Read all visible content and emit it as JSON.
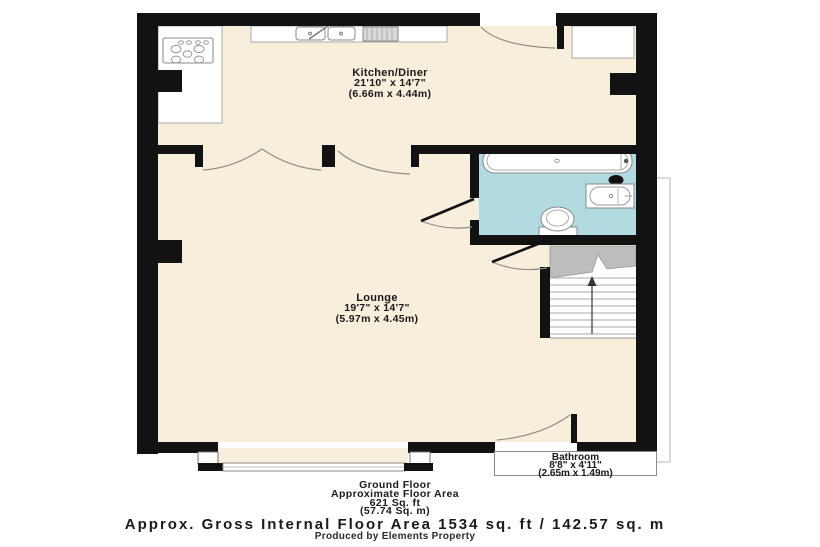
{
  "colors": {
    "wall": "#121212",
    "floor_cream": "#f7eedc",
    "bathroom_blue": "#b2dbe1",
    "stairs_gray": "#bdbdbd"
  },
  "rooms": {
    "kitchen": {
      "name": "Kitchen/Diner",
      "dims_ft": "21'10\" x 14'7\"",
      "dims_m": "(6.66m x 4.44m)"
    },
    "lounge": {
      "name": "Lounge",
      "dims_ft": "19'7\" x 14'7\"",
      "dims_m": "(5.97m x 4.45m)"
    },
    "bathroom": {
      "name": "Bathroom",
      "dims_ft": "8'8\" x 4'11\"",
      "dims_m": "(2.65m x 1.49m)"
    }
  },
  "footer": {
    "floor_name": "Ground Floor",
    "area_label": "Approximate Floor Area",
    "area_sqft": "621 Sq. ft",
    "area_sqm": "(57.74 Sq. m)",
    "gross_area": "Approx. Gross Internal Floor Area 1534 sq. ft / 142.57 sq. m",
    "credit": "Produced by Elements Property"
  }
}
